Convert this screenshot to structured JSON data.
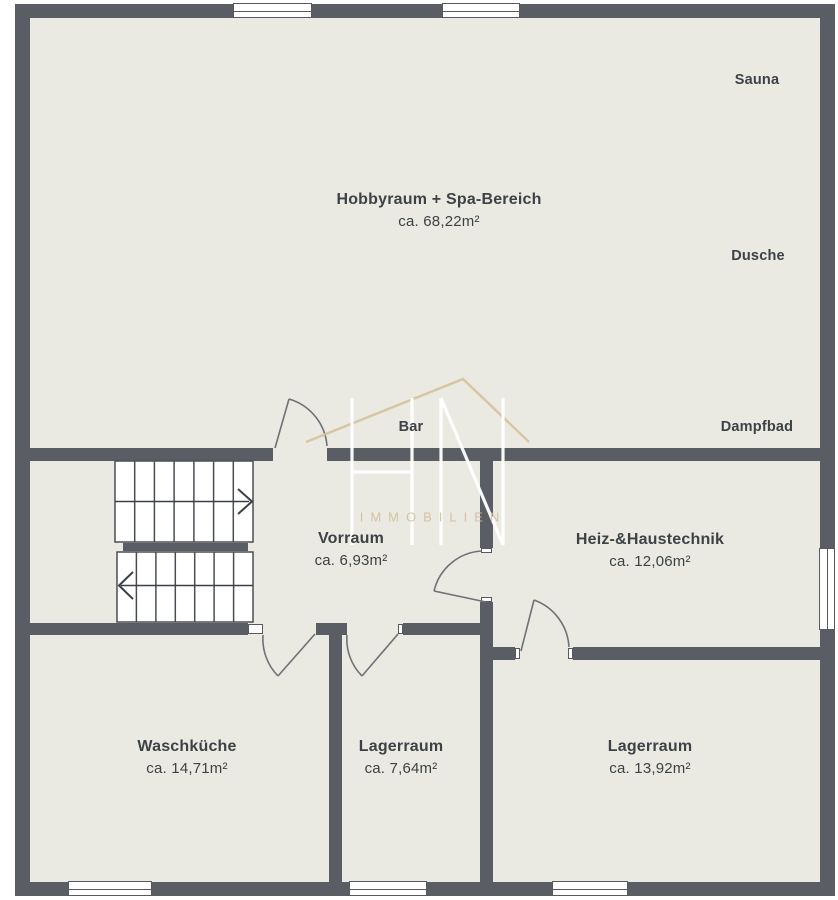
{
  "plan": {
    "rooms": [
      {
        "id": "hobbyraum",
        "name": "Hobbyraum + Spa-Bereich",
        "area": "ca. 68,22m²"
      },
      {
        "id": "vorraum",
        "name": "Vorraum",
        "area": "ca. 6,93m²"
      },
      {
        "id": "heiz",
        "name": "Heiz-&Haustechnik",
        "area": "ca. 12,06m²"
      },
      {
        "id": "waschkueche",
        "name": "Waschküche",
        "area": "ca. 14,71m²"
      },
      {
        "id": "lagerraum_klein",
        "name": "Lagerraum",
        "area": "ca. 7,64m²"
      },
      {
        "id": "lagerraum_gross",
        "name": "Lagerraum",
        "area": "ca. 13,92m²"
      }
    ],
    "features": {
      "sauna": "Sauna",
      "dusche": "Dusche",
      "dampfbad": "Dampfbad",
      "bar": "Bar"
    }
  },
  "watermark": {
    "brand": "HN",
    "subtitle": "IMMOBILIEN"
  },
  "colors": {
    "wall": "#5a5e64",
    "floor": "#eaeae2",
    "accent_roof": "#d5c29c",
    "text": "#3d4247"
  }
}
